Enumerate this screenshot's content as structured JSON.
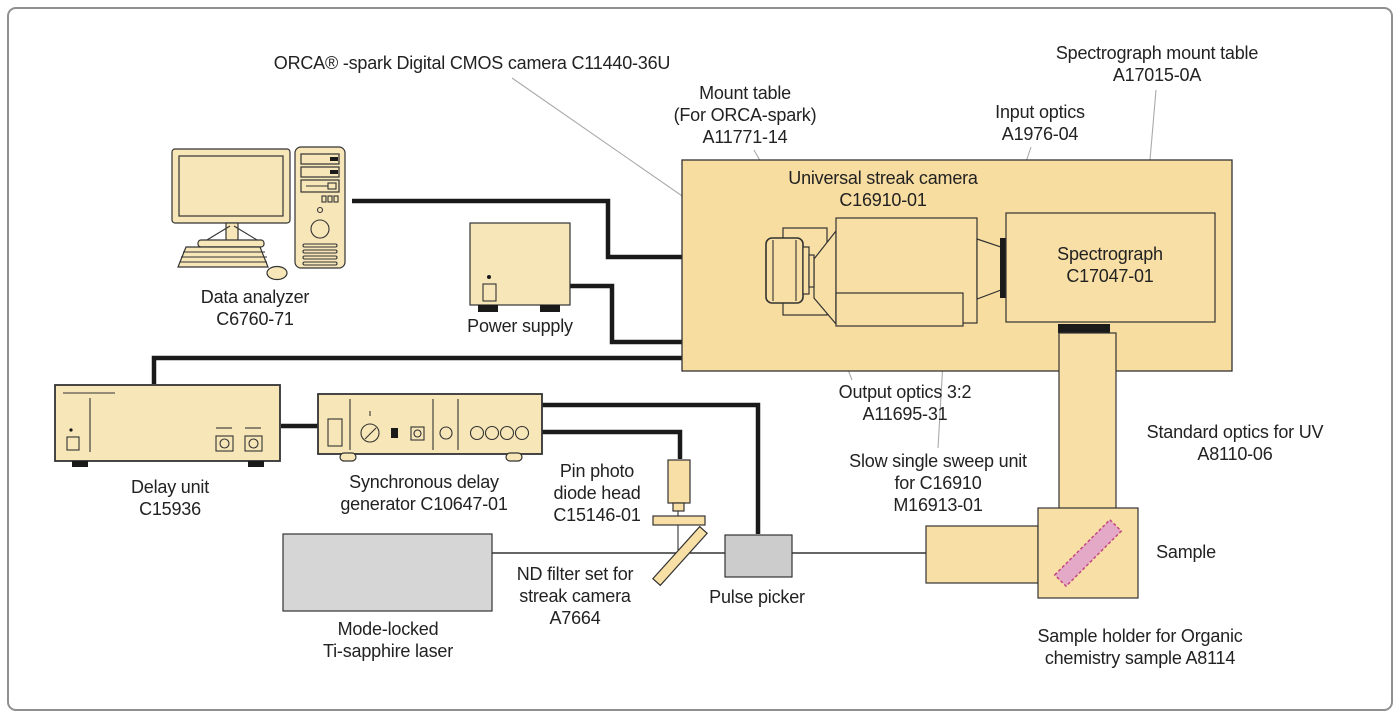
{
  "diagram_title": "Universal streak camera system configuration",
  "labels": {
    "orca": "ORCA® -spark Digital CMOS camera C11440-36U",
    "spectrograph_mount": [
      "Spectrograph mount table",
      "A17015-0A"
    ],
    "mount_table": [
      "Mount table",
      "(For ORCA-spark)",
      "A11771-14"
    ],
    "input_optics": [
      "Input optics",
      "A1976-04"
    ],
    "streak_camera": [
      "Universal streak camera",
      "C16910-01"
    ],
    "spectrograph": [
      "Spectrograph",
      "C17047-01"
    ],
    "data_analyzer": [
      "Data analyzer",
      "C6760-71"
    ],
    "power_supply": "Power supply",
    "delay_unit": [
      "Delay unit",
      "C15936"
    ],
    "sync_generator": [
      "Synchronous delay",
      "generator C10647-01"
    ],
    "pin_photo": [
      "Pin photo",
      "diode head",
      "C15146-01"
    ],
    "nd_filter": [
      "ND filter set for",
      "streak camera",
      "A7664"
    ],
    "laser": [
      "Mode-locked",
      "Ti-sapphire laser"
    ],
    "pulse_picker": "Pulse picker",
    "output_optics": [
      "Output optics 3:2",
      "A11695-31"
    ],
    "sweep_unit": [
      "Slow single sweep unit",
      "for C16910",
      "M16913-01"
    ],
    "uv_optics": [
      "Standard optics for UV",
      "A8110-06"
    ],
    "sample": "Sample",
    "sample_holder": [
      "Sample holder for Organic",
      "chemistry sample A8114"
    ]
  },
  "colors": {
    "frame": "#909090",
    "panel": "#f8dda1",
    "tan": "#f8dfa5",
    "cream": "#f7e6b8",
    "gray": "#d6d6d6",
    "picker": "#cccccc",
    "outline": "#333333",
    "cable": "#1a1a1a",
    "pink": "#e4a9c6",
    "pinkborder": "#c2477f",
    "leader": "#aaaaaa"
  }
}
